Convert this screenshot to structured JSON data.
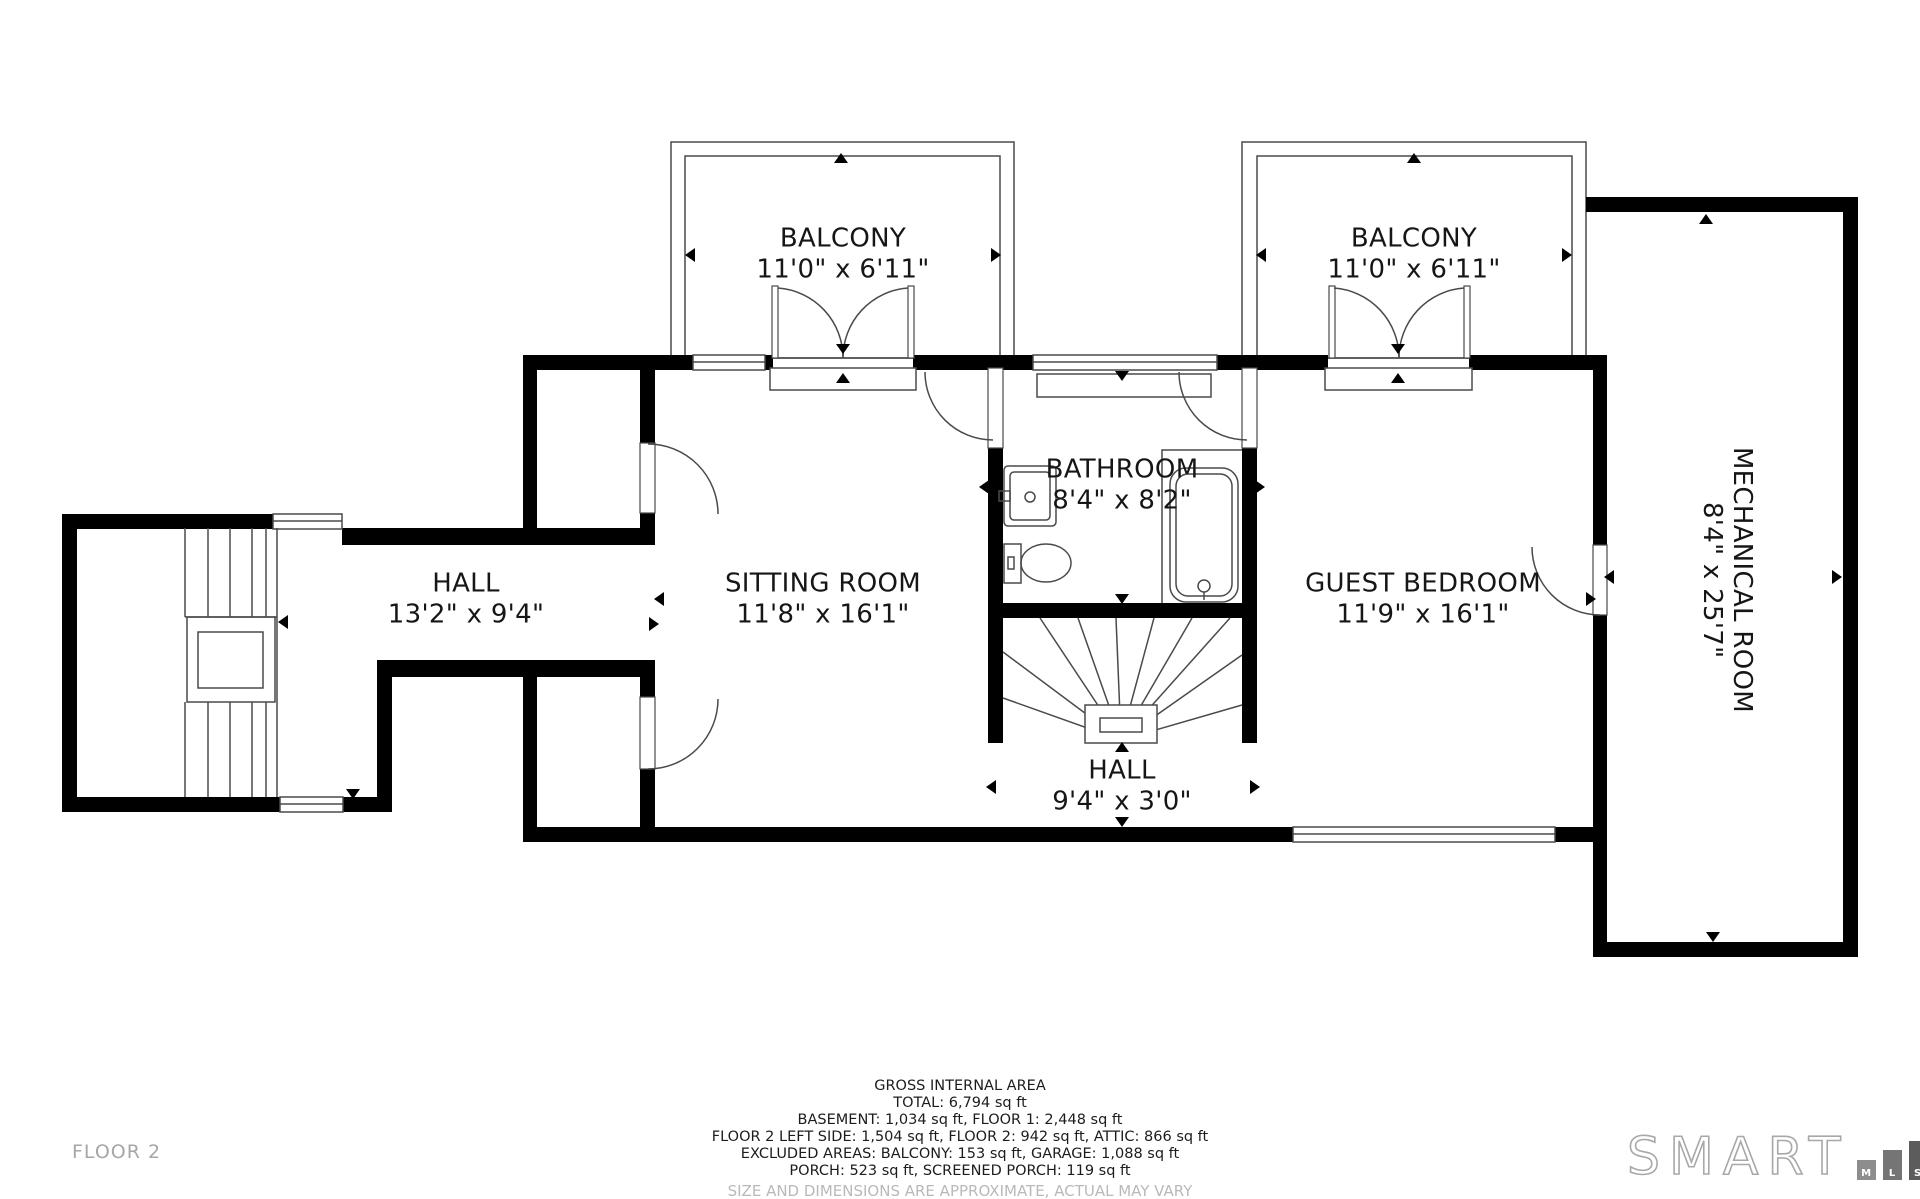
{
  "floor_label": "FLOOR 2",
  "rooms": {
    "balcony_left": {
      "name": "BALCONY",
      "dims": "11'0\" x 6'11\""
    },
    "balcony_right": {
      "name": "BALCONY",
      "dims": "11'0\" x 6'11\""
    },
    "hall_left": {
      "name": "HALL",
      "dims": "13'2\" x 9'4\""
    },
    "sitting_room": {
      "name": "SITTING ROOM",
      "dims": "11'8\" x 16'1\""
    },
    "bathroom": {
      "name": "BATHROOM",
      "dims": "8'4\" x 8'2\""
    },
    "guest_bedroom": {
      "name": "GUEST BEDROOM",
      "dims": "11'9\" x 16'1\""
    },
    "hall_center": {
      "name": "HALL",
      "dims": "9'4\" x 3'0\""
    },
    "mechanical_room": {
      "name": "MECHANICAL ROOM",
      "dims": "8'4\" x 25'7\""
    }
  },
  "footer": {
    "line1": "GROSS INTERNAL AREA",
    "line2": "TOTAL: 6,794 sq ft",
    "line3": "BASEMENT: 1,034 sq ft, FLOOR 1: 2,448 sq ft",
    "line4": "FLOOR 2 LEFT SIDE: 1,504 sq ft, FLOOR 2: 942 sq ft, ATTIC: 866 sq ft",
    "line5": "EXCLUDED AREAS: BALCONY: 153 sq ft, GARAGE: 1,088 sq ft",
    "line6": "PORCH: 523 sq ft, SCREENED PORCH: 119 sq ft",
    "disclaimer": "SIZE AND DIMENSIONS ARE APPROXIMATE, ACTUAL MAY VARY"
  },
  "logo": {
    "brand": "SMART",
    "m": "M",
    "l": "L",
    "s": "S"
  },
  "colors": {
    "wall": "#000000",
    "line": "#4a4a4a",
    "text": "#161616",
    "muted": "#a6a6a6"
  }
}
